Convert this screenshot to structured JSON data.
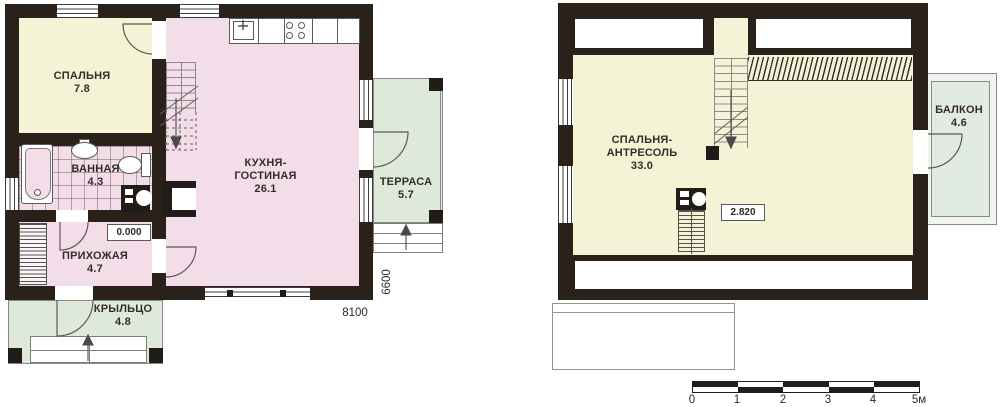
{
  "floor1": {
    "bedroom_name": "СПАЛЬНЯ",
    "bedroom_area": "7.8",
    "bathroom_name": "ВАННАЯ",
    "bathroom_area": "4.3",
    "hallway_name": "ПРИХОЖАЯ",
    "hallway_area": "4.7",
    "kitchen_name1": "КУХНЯ-",
    "kitchen_name2": "ГОСТИНАЯ",
    "kitchen_area": "26.1",
    "porch_name": "КРЫЛЬЦО",
    "porch_area": "4.8",
    "terrace_name": "ТЕРРАСА",
    "terrace_area": "5.7",
    "level_mark": "0.000",
    "dim_horizontal": "8100",
    "dim_vertical": "6600"
  },
  "floor2": {
    "room_name1": "СПАЛЬНЯ-",
    "room_name2": "АНТРЕСОЛЬ",
    "room_area": "33.0",
    "balcony_name": "БАЛКОН",
    "balcony_area": "4.6",
    "level_mark": "2.820"
  },
  "scale_bar": {
    "labels": [
      "0",
      "1",
      "2",
      "3",
      "4",
      "5м"
    ]
  },
  "colors": {
    "wall": "#2a211b",
    "room_yellow": "#f4f3d5",
    "room_pink": "#f3dde8",
    "outdoor_green": "#dfe9da",
    "balcony_fill": "#e2ebe1"
  }
}
